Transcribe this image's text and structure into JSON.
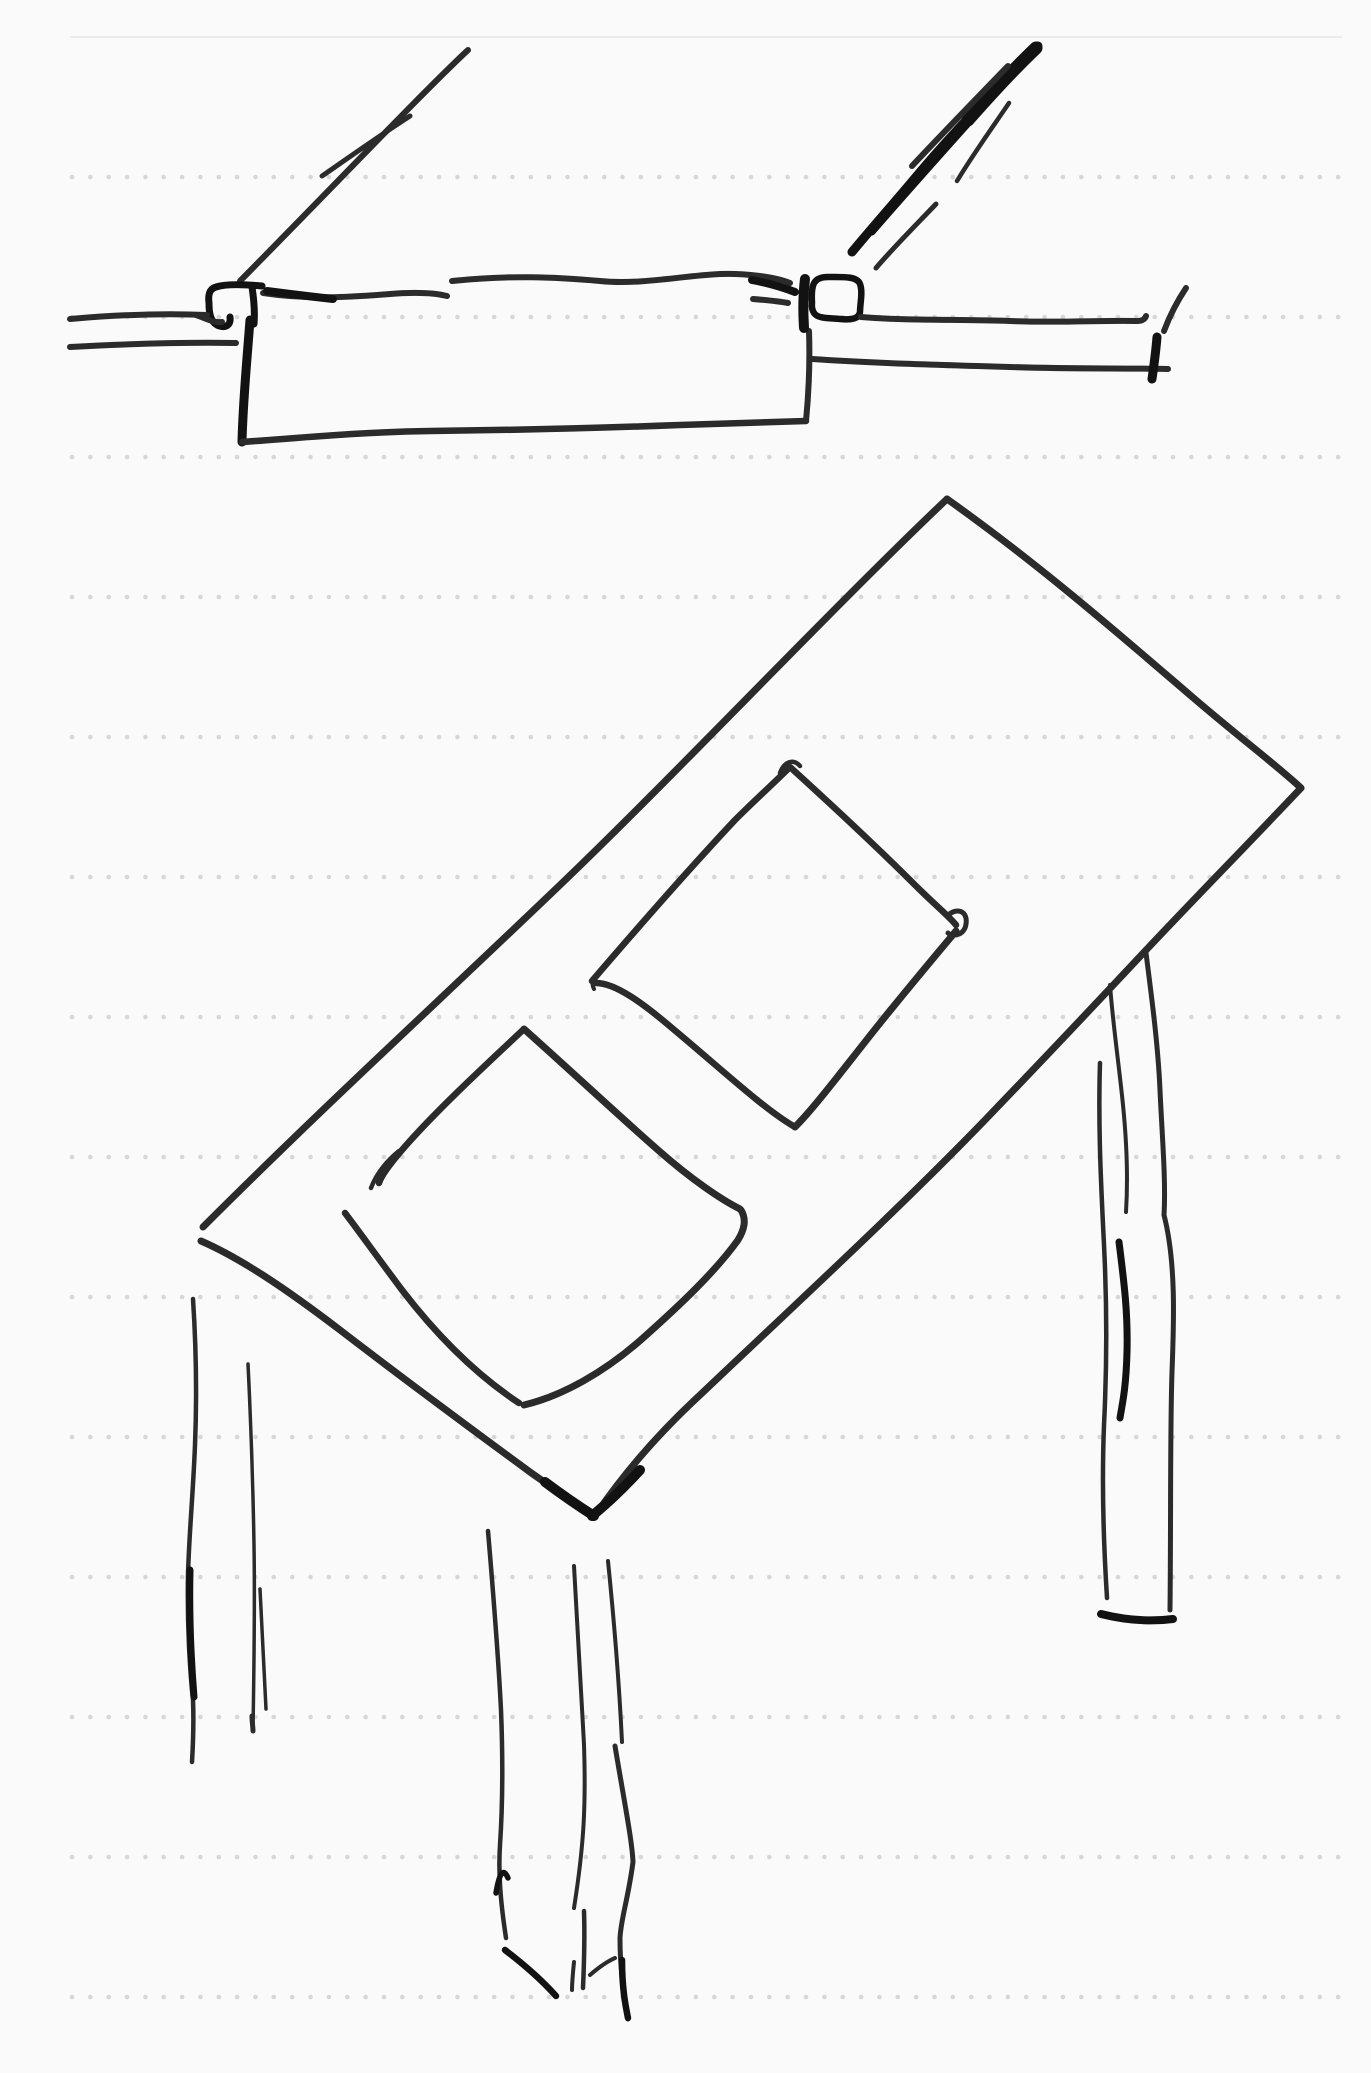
{
  "page": {
    "title": "Dot-grid sketch page",
    "background": "#fafafa",
    "width": 1371,
    "height": 2073
  },
  "grid": {
    "margin_line": {
      "y": 37,
      "x1": 70,
      "x2": 1342,
      "color": "#ebebeb",
      "width": 2
    },
    "dot_rows": {
      "first_y": 177,
      "spacing_y": 140,
      "count": 14,
      "dot_first_x": 72,
      "dot_spacing_x": 18.35,
      "dot_last_x": 1342,
      "dot_radius": 2.3,
      "color": "#d7d7d7"
    }
  },
  "ink": {
    "base": "#2b2b2b",
    "bold": "#121212"
  },
  "drawing": {
    "label": "hand-drawn table design sketch (edge section above, table top perspective below)",
    "groups": [
      {
        "name": "table-edge-section-sketch",
        "strokes": [
          {
            "d": "M468,50 C420,95 330,190 240,281",
            "w": 6
          },
          {
            "d": "M410,116 C382,134 348,158 322,176",
            "w": 5
          },
          {
            "d": "M1038,46 C1000,85 955,130 915,178 C895,202 870,230 852,252",
            "w": 9,
            "bold": true
          },
          {
            "d": "M1036,48 C1015,68 990,95 968,120",
            "w": 13,
            "bold": true
          },
          {
            "d": "M1030,54 C985,105 930,165 872,232",
            "w": 7,
            "bold": true
          },
          {
            "d": "M1008,66 C975,100 942,134 912,166",
            "w": 6
          },
          {
            "d": "M1009,103 C992,128 972,156 957,181",
            "w": 4.5
          },
          {
            "d": "M936,204 C915,226 893,248 876,268",
            "w": 5
          },
          {
            "d": "M263,293 C310,300 350,297 390,294 C415,292 435,293 447,296",
            "w": 6
          },
          {
            "d": "M267,291 C290,294 315,297 333,299",
            "w": 8,
            "bold": true
          },
          {
            "d": "M452,281 C510,275 555,277 600,281 C640,285 680,276 720,274 C745,273 775,277 790,283",
            "w": 6
          },
          {
            "d": "M752,280 C768,283 782,287 795,292",
            "w": 8,
            "bold": true
          },
          {
            "d": "M262,286 C240,284 225,284 216,287 C209,289 208,295 209,303 C209,312 210,321 217,325 C226,329 231,325 230,317",
            "w": 7,
            "bold": true
          },
          {
            "d": "M252,287 C254,300 255,312 254,324",
            "w": 7,
            "bold": true
          },
          {
            "d": "M70,319 C115,315 160,313 207,315",
            "w": 6
          },
          {
            "d": "M196,315 C205,318 213,323 222,322",
            "w": 6
          },
          {
            "d": "M70,347 C125,344 180,342 236,343",
            "w": 6
          },
          {
            "d": "M250,320 C247,360 243,400 242,442",
            "w": 9,
            "bold": true
          },
          {
            "d": "M242,442 C300,438 360,432 430,431 C520,430 600,428 680,425 C740,423 780,422 806,421",
            "w": 6.5
          },
          {
            "d": "M806,421 C809,390 810,360 809,331",
            "w": 6
          },
          {
            "d": "M805,279 C803,295 803,312 804,328",
            "w": 10,
            "bold": true
          },
          {
            "d": "M812,303 C811,285 813,277 828,277 C843,277 857,276 860,284 C863,292 860,304 860,312 C859,319 851,320 840,319 C830,318 818,319 814,313 C811,308 812,305 812,303",
            "w": 6.5,
            "bold": true
          },
          {
            "d": "M753,299 C765,300 777,301 788,303",
            "w": 6
          },
          {
            "d": "M861,317 C910,321 960,319 1010,321 C1060,323 1105,320 1138,321 C1142,321 1145,319 1146,316",
            "w": 6
          },
          {
            "d": "M812,359 C870,363 940,365 1010,367 C1070,369 1120,368 1168,369",
            "w": 6
          },
          {
            "d": "M1157,337 C1156,350 1154,365 1152,379",
            "w": 9,
            "bold": true
          },
          {
            "d": "M1186,288 C1178,300 1170,315 1164,331",
            "w": 6
          }
        ]
      },
      {
        "name": "table-top-perspective-sketch",
        "strokes": [
          {
            "d": "M203,1227 C320,1110 440,1000 560,885 C680,770 830,610 947,499",
            "w": 7
          },
          {
            "d": "M947,499 C1040,565 1120,635 1190,695 C1240,738 1280,768 1301,788",
            "w": 7
          },
          {
            "d": "M1301,788 C1250,842 1195,898 1148,948 C1090,1010 1035,1068 985,1120 C900,1208 800,1300 700,1395 C660,1432 625,1472 597,1513",
            "w": 7
          },
          {
            "d": "M640,1470 C620,1492 605,1505 592,1516",
            "w": 10,
            "bold": true
          },
          {
            "d": "M201,1241 C240,1258 285,1288 340,1330 C400,1376 470,1428 530,1472 C555,1490 578,1504 593,1515",
            "w": 7
          },
          {
            "d": "M545,1482 C565,1497 580,1507 594,1516",
            "w": 10,
            "bold": true
          },
          {
            "d": "M592,981 C640,925 690,868 735,820 C755,800 775,782 789,768",
            "w": 6.5
          },
          {
            "d": "M780,773 C784,762 793,758 800,766",
            "w": 4.5
          },
          {
            "d": "M790,767 C835,808 880,850 915,885 C935,905 950,917 956,925",
            "w": 6.5
          },
          {
            "d": "M947,916 C958,906 968,912 966,924 C965,934 954,938 948,933",
            "w": 5
          },
          {
            "d": "M956,931 C930,962 898,1000 865,1042 C835,1080 812,1110 795,1127",
            "w": 7
          },
          {
            "d": "M795,1127 C765,1110 720,1068 672,1028 C645,1005 615,982 595,983",
            "w": 6.5
          },
          {
            "d": "M602,971 C595,976 590,982 594,989",
            "w": 4
          },
          {
            "d": "M524,1029 C478,1072 432,1115 402,1150 C390,1164 381,1176 379,1183",
            "w": 6.5
          },
          {
            "d": "M371,1188 C377,1172 388,1160 399,1151",
            "w": 4.5
          },
          {
            "d": "M345,1213 C358,1230 378,1258 402,1290 C435,1333 475,1374 519,1403",
            "w": 6.5
          },
          {
            "d": "M524,1029 C570,1070 618,1115 658,1150 C692,1180 722,1200 740,1209",
            "w": 7
          },
          {
            "d": "M741,1210 C747,1220 744,1230 738,1240 C715,1272 680,1305 643,1338 C605,1372 562,1396 524,1405",
            "w": 7
          },
          {
            "d": "M1146,953 C1152,1000 1158,1045 1160,1090 C1162,1135 1166,1180 1164,1215 C1176,1262 1174,1320 1172,1372 C1170,1430 1171,1520 1170,1610",
            "w": 5
          },
          {
            "d": "M1110,985 C1113,1025 1119,1065 1123,1105 C1127,1145 1128,1180 1126,1212",
            "w": 4
          },
          {
            "d": "M1100,1063 C1098,1125 1101,1185 1104,1245 C1107,1305 1107,1365 1104,1425 C1102,1475 1103,1535 1107,1598",
            "w": 4.5
          },
          {
            "d": "M1119,1242 C1124,1282 1128,1312 1127,1352 C1126,1390 1122,1405 1120,1418",
            "w": 7,
            "bold": true
          },
          {
            "d": "M1101,1614 C1125,1620 1150,1622 1173,1619",
            "w": 8,
            "bold": true
          },
          {
            "d": "M193,1299 C196,1345 197,1395 195,1445 C193,1495 189,1535 188,1575 C187,1625 190,1672 193,1700 C194,1725 193,1745 192,1762",
            "w": 4.5
          },
          {
            "d": "M190,1570 C189,1615 191,1660 194,1697",
            "w": 7,
            "bold": true
          },
          {
            "d": "M248,1364 C251,1425 253,1485 254,1545 C255,1605 254,1670 253,1729",
            "w": 3.5
          },
          {
            "d": "M252,1716 C252,1722 253,1727 253,1731",
            "w": 5
          },
          {
            "d": "M260,1589 C262,1630 264,1670 266,1709",
            "w": 3.5
          },
          {
            "d": "M488,1531 C493,1590 498,1650 501,1710 C503,1760 503,1800 500,1845 C498,1875 501,1905 506,1938",
            "w": 4.5
          },
          {
            "d": "M496,1893 C499,1875 503,1866 508,1878",
            "w": 5.5,
            "bold": true
          },
          {
            "d": "M505,1950 C522,1963 540,1978 556,1996",
            "w": 6.5,
            "bold": true
          },
          {
            "d": "M574,1566 C577,1625 581,1685 584,1745 C586,1805 584,1845 574,1908",
            "w": 4
          },
          {
            "d": "M584,1911 C585,1940 584,1965 583,1988",
            "w": 4.5
          },
          {
            "d": "M574,1962 C573,1972 572,1982 572,1990",
            "w": 4
          },
          {
            "d": "M590,1975 C598,1968 606,1962 615,1958",
            "w": 4
          },
          {
            "d": "M608,1561 C614,1620 619,1680 622,1742",
            "w": 4
          },
          {
            "d": "M615,1746 C624,1800 632,1840 633,1862 C628,1900 621,1918 620,1938 C620,1978 626,2002 628,2019",
            "w": 5
          },
          {
            "d": "M622,1960 C622,1990 626,2008 628,2018",
            "w": 6.5,
            "bold": true
          }
        ]
      }
    ]
  }
}
